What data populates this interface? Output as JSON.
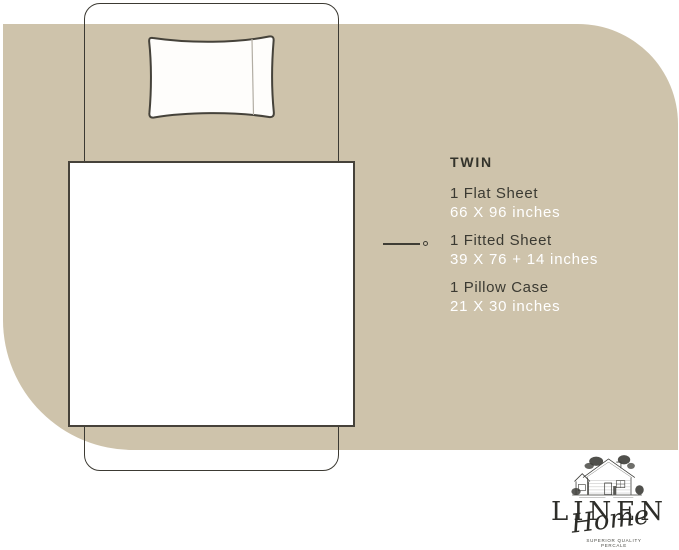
{
  "title": "Twin bed sheet set size infographic",
  "size": {
    "label": "TWIN"
  },
  "specs": [
    {
      "label": "1 Flat Sheet",
      "value": "66 X 96 inches"
    },
    {
      "label": "1 Fitted Sheet",
      "value": "39 X 76 + 14 inches"
    },
    {
      "label": "1 Pillow Case",
      "value": "21 X 30 inches"
    }
  ],
  "brand": {
    "name": "LINEN",
    "script": "Home",
    "tagline": [
      "SUPERIOR QUALITY",
      "PERCALE"
    ]
  },
  "colors": {
    "backdrop_beige": "#cec3ab",
    "ink_dark": "#3b3a32",
    "value_white": "#ffffff",
    "outline": "#3c3a33"
  }
}
